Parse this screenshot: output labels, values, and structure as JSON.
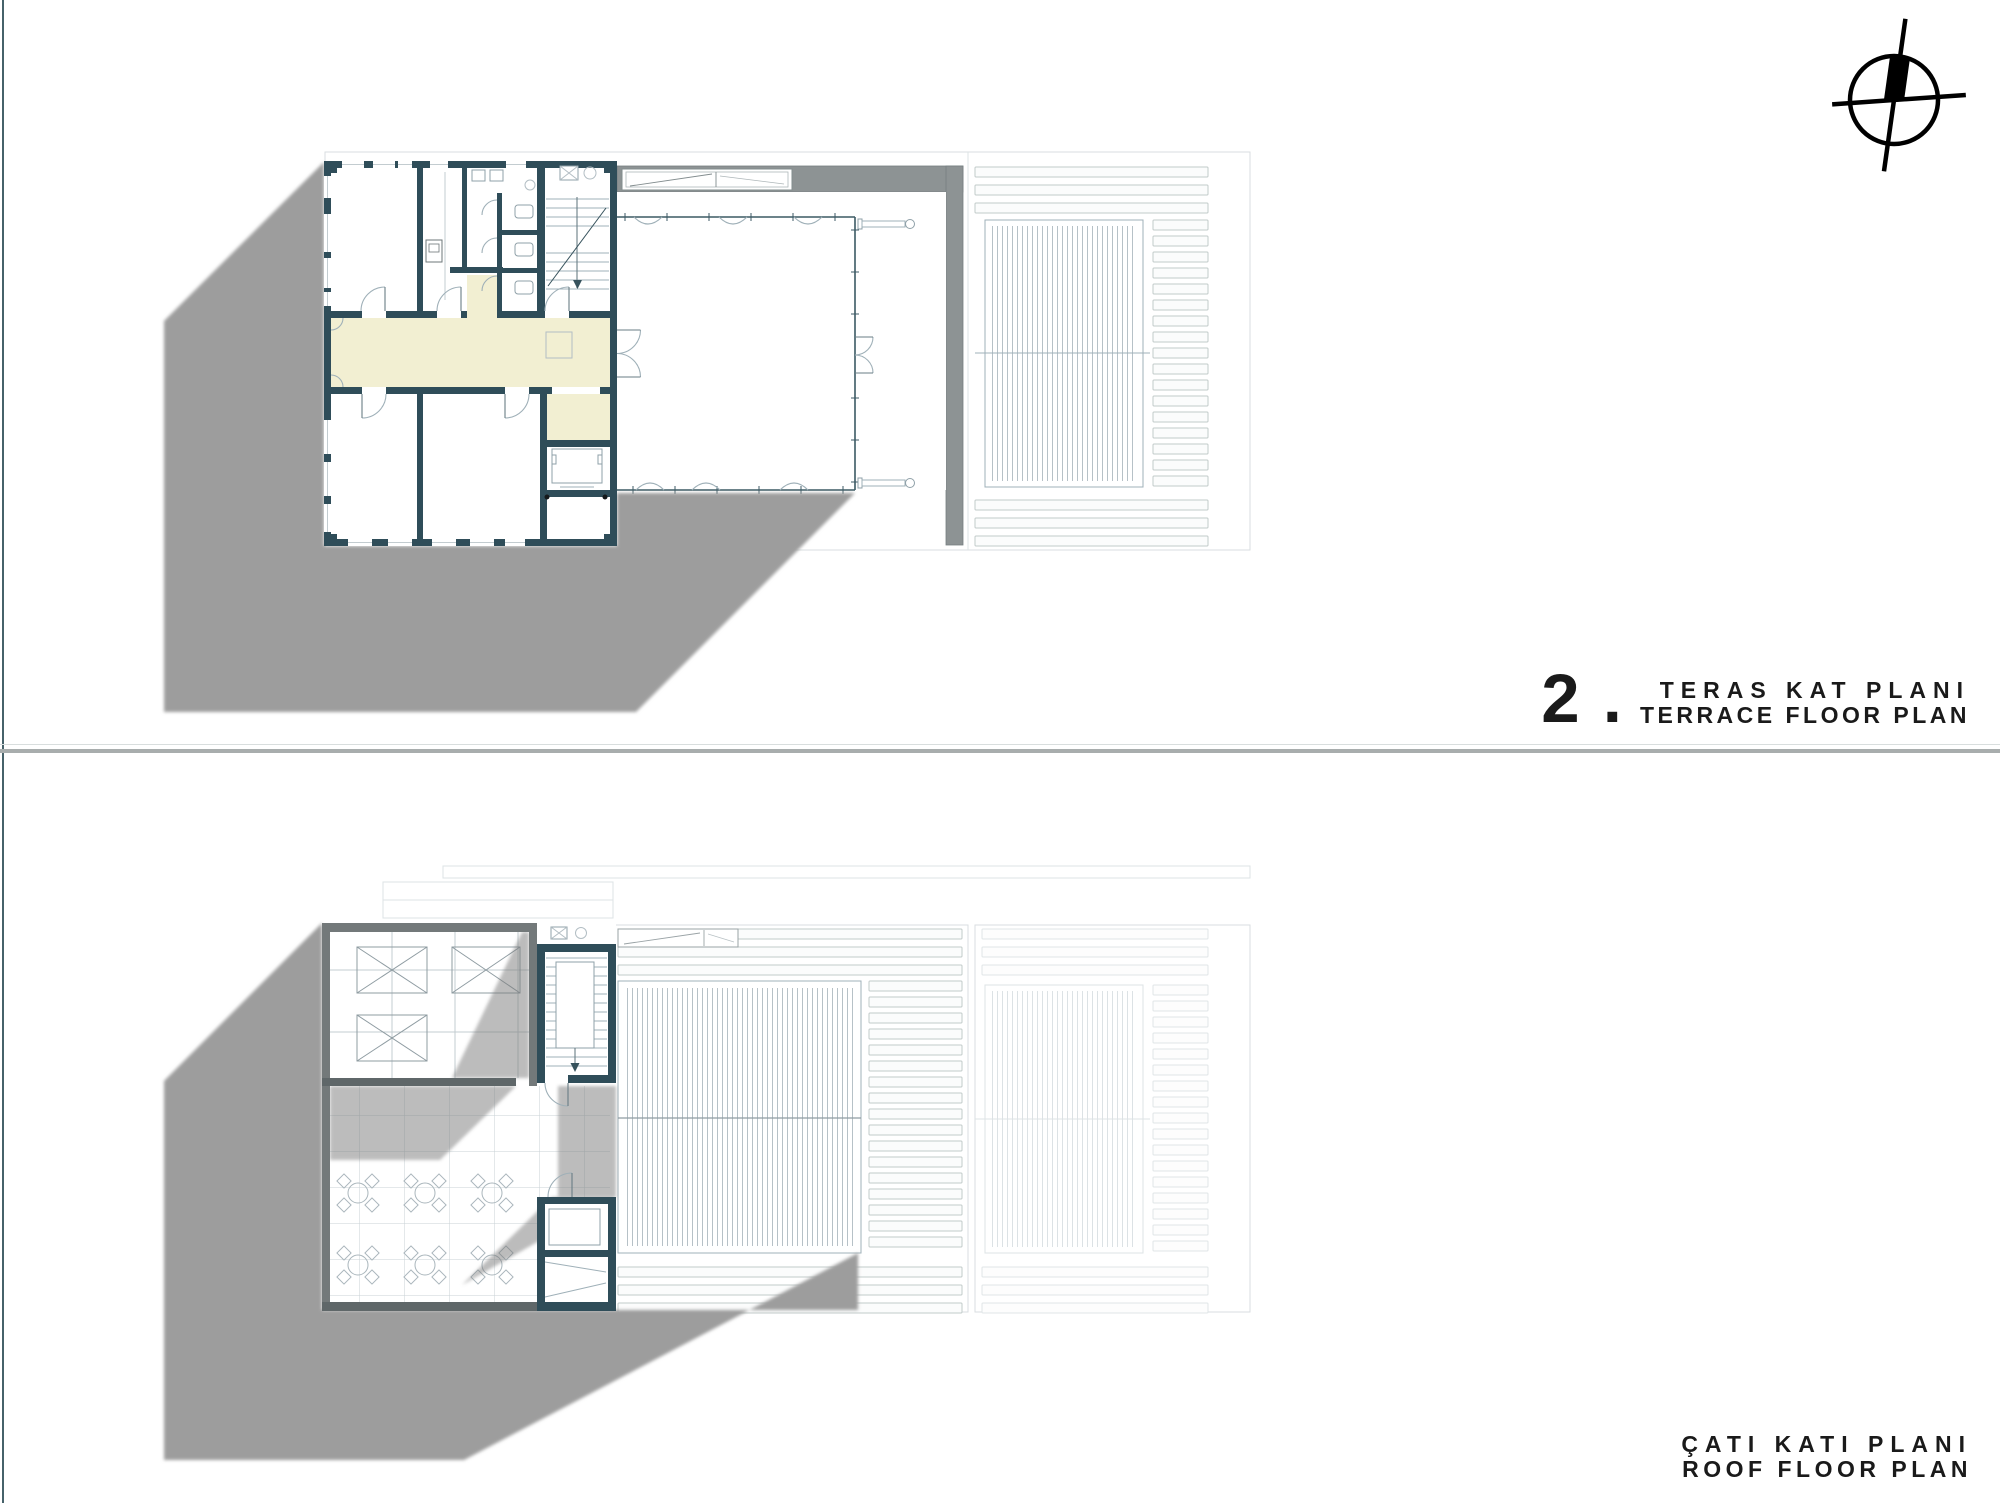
{
  "sheet": {
    "panel_terrace": {
      "number": "2 .",
      "title_primary": "TERAS KAT PLANI",
      "title_secondary": "TERRACE FLOOR PLAN"
    },
    "panel_roof": {
      "title_primary": "ÇATI KATI PLANI",
      "title_secondary": "ROOF FLOOR PLAN"
    }
  },
  "icons": {
    "north_arrow": "north-arrow"
  },
  "colors": {
    "wall": "#2f4d59",
    "corridor": "#f2efd2",
    "shadow": "#9d9d9d",
    "roof_wall": "#8d9394",
    "parapet": "#73797a",
    "text": "#1a1a1a"
  }
}
